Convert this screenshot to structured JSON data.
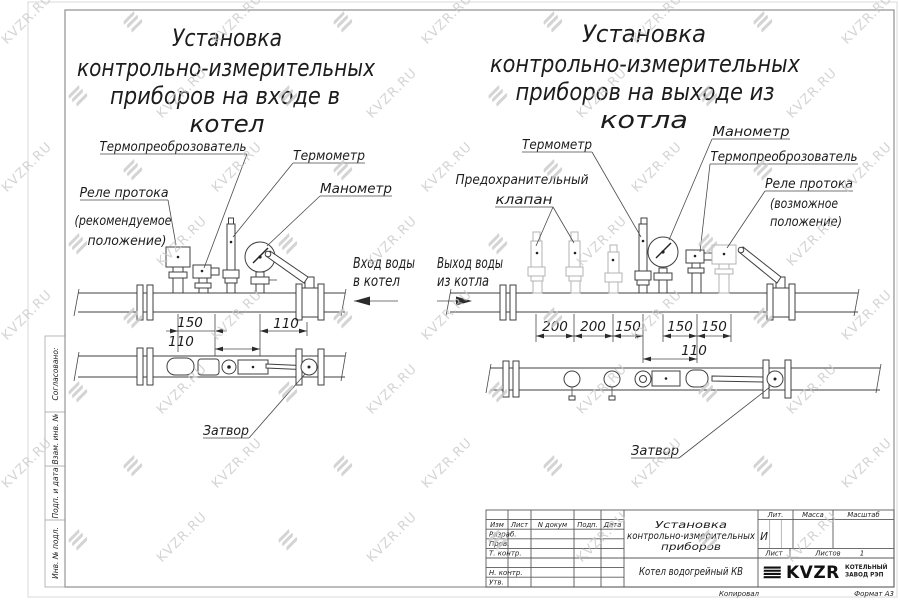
{
  "watermark": {
    "text": "KVZR.RU"
  },
  "left_view": {
    "title_lines": [
      "Установка",
      "контрольно-измерительных",
      "приборов на входе в",
      "котел"
    ],
    "labels": {
      "transducer": "Термопреоброзователь",
      "thermometer": "Термометр",
      "manometer": "Манометр",
      "flow_relay_1": "Реле протока",
      "flow_relay_2": "(рекомендуемое",
      "flow_relay_3": "положение)",
      "inlet_1": "Вход воды",
      "inlet_2": "в котел",
      "valve": "Затвор"
    },
    "dims": [
      "150",
      "110",
      "110"
    ]
  },
  "right_view": {
    "title_lines": [
      "Установка",
      "контрольно-измерительных",
      "приборов на выходе из",
      "котла"
    ],
    "labels": {
      "thermometer": "Термометр",
      "safety_valve_1": "Предохранительный",
      "safety_valve_2": "клапан",
      "manometer": "Манометр",
      "transducer": "Термопреоброзователь",
      "flow_relay_1": "Реле протока",
      "flow_relay_2": "(возможное",
      "flow_relay_3": "положение)",
      "outlet_1": "Выход воды",
      "outlet_2": "из котла",
      "valve": "Затвор"
    },
    "dims": [
      "200",
      "200",
      "150",
      "150",
      "150",
      "110"
    ]
  },
  "side_column": {
    "labels": [
      "Согласовано:",
      "Взам. инв. №",
      "Подп. и дата",
      "Инв. № подл."
    ]
  },
  "title_block": {
    "header_cols": [
      "Изм",
      "Лист",
      "N докум",
      "Подп.",
      "Дата"
    ],
    "sign_rows": [
      "Разраб.",
      "Пров.",
      "Т. контр.",
      "Н. контр.",
      "Утв."
    ],
    "doc_title_lines": [
      "Установка",
      "контрольно-измерительных",
      "приборов"
    ],
    "product": "Котел водогрейный КВ",
    "lit_label": "Лит.",
    "lit_value": "И",
    "mass_label": "Масса",
    "scale_label": "Масштаб",
    "sheet_label": "Лист",
    "sheets_label": "Листов",
    "sheets_value": "1",
    "logo_text": "KVZR",
    "company_1": "КОТЕЛЬНЫЙ",
    "company_2": "ЗАВОД РЭП",
    "copied": "Копировал",
    "format": "Формат А3"
  }
}
